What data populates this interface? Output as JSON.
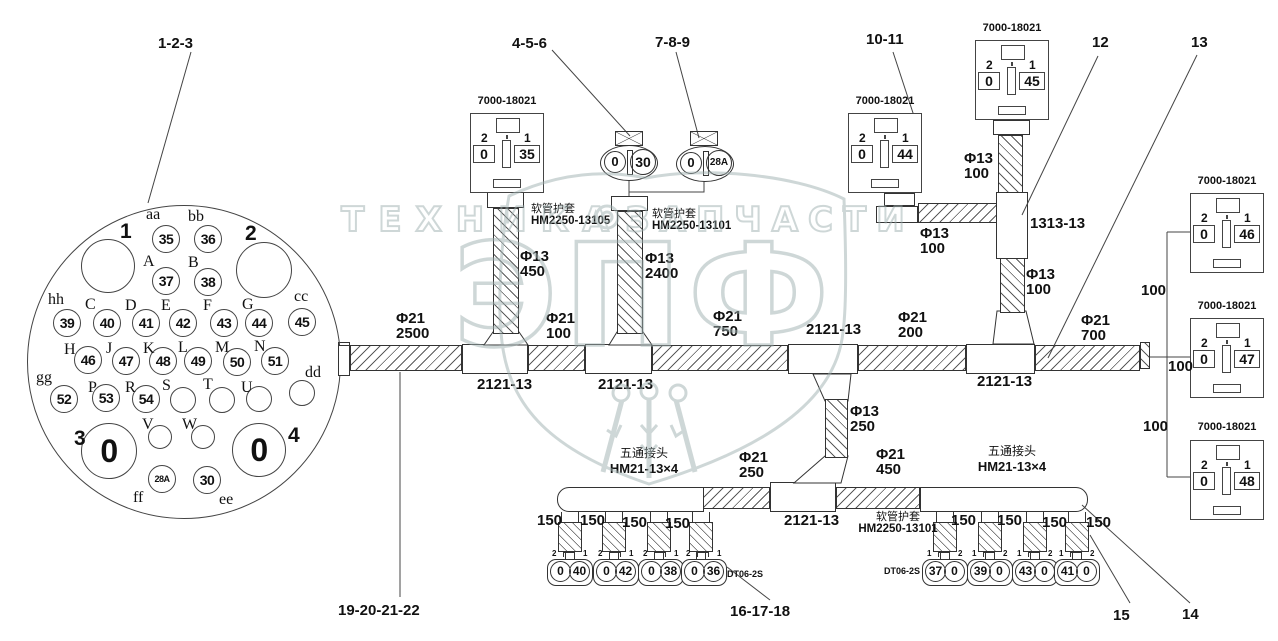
{
  "callouts": {
    "g1": "1-2-3",
    "g2": "4-5-6",
    "g3": "7-8-9",
    "g4": "10-11",
    "g5": "12",
    "g6": "13",
    "g7": "14",
    "g8": "15",
    "g9": "16-17-18",
    "g10": "19-20-21-22"
  },
  "part_numbers": {
    "square_connector": "7000-18021",
    "small_connector": "DT06-2S",
    "tee": "2121-13",
    "y_joint": "1313-13",
    "five_way_cn": "五通接头",
    "five_way": "HM21-13×4",
    "sleeve_cn": "软管护套",
    "sleeve_13105": "HM2250-13105",
    "sleeve_13101": "HM2250-13101"
  },
  "tubes": {
    "t2500": {
      "d": "Φ21",
      "l": "2500"
    },
    "t100a": {
      "d": "Φ21",
      "l": "100"
    },
    "t750": {
      "d": "Φ21",
      "l": "750"
    },
    "t200": {
      "d": "Φ21",
      "l": "200"
    },
    "t700": {
      "d": "Φ21",
      "l": "700"
    },
    "t450": {
      "d": "Φ13",
      "l": "450"
    },
    "t2400": {
      "d": "Φ13",
      "l": "2400"
    },
    "t100b": {
      "d": "Φ13",
      "l": "100"
    },
    "t100c": {
      "d": "Φ13",
      "l": "100"
    },
    "t100d": {
      "d": "Φ13",
      "l": "100"
    },
    "t250": {
      "d": "Φ13",
      "l": "250"
    },
    "t250b": {
      "d": "Φ21",
      "l": "250"
    },
    "t450b": {
      "d": "Φ21",
      "l": "450"
    }
  },
  "lengths": {
    "l150": "150",
    "l100": "100"
  },
  "sq_boxes": {
    "b35": {
      "pl": "2",
      "vl": "0",
      "pr": "1",
      "vr": "35"
    },
    "b44": {
      "pl": "2",
      "vl": "0",
      "pr": "1",
      "vr": "44"
    },
    "b45": {
      "pl": "2",
      "vl": "0",
      "pr": "1",
      "vr": "45"
    },
    "b46": {
      "pl": "2",
      "vl": "0",
      "pr": "1",
      "vr": "46"
    },
    "b47": {
      "pl": "2",
      "vl": "0",
      "pr": "1",
      "vr": "47"
    },
    "b48": {
      "pl": "2",
      "vl": "0",
      "pr": "1",
      "vr": "48"
    }
  },
  "ovals": {
    "o30": {
      "l": "0",
      "r": "30"
    },
    "o28a": {
      "l": "0",
      "r": "28A"
    }
  },
  "bconns": {
    "c40": {
      "pl": "2",
      "pr": "1",
      "l": "0",
      "r": "40"
    },
    "c42": {
      "pl": "2",
      "pr": "1",
      "l": "0",
      "r": "42"
    },
    "c38": {
      "pl": "2",
      "pr": "1",
      "l": "0",
      "r": "38"
    },
    "c36": {
      "pl": "2",
      "pr": "1",
      "l": "0",
      "r": "36"
    },
    "c37": {
      "pl": "1",
      "pr": "2",
      "l": "37",
      "r": "0"
    },
    "c39": {
      "pl": "1",
      "pr": "2",
      "l": "39",
      "r": "0"
    },
    "c43": {
      "pl": "1",
      "pr": "2",
      "l": "43",
      "r": "0"
    },
    "c41": {
      "pl": "1",
      "pr": "2",
      "l": "41",
      "r": "0"
    }
  },
  "circle": {
    "big1": {
      "label": "1"
    },
    "big2": {
      "label": "2"
    },
    "big3": {
      "label": "3",
      "num": "0"
    },
    "big4": {
      "label": "4",
      "num": "0"
    },
    "p35": {
      "label": "aa",
      "num": "35"
    },
    "p36": {
      "label": "bb",
      "num": "36"
    },
    "p37": {
      "label": "A",
      "num": "37"
    },
    "p38": {
      "label": "B",
      "num": "38"
    },
    "p39": {
      "label": "hh",
      "num": "39"
    },
    "p40": {
      "label": "C",
      "num": "40"
    },
    "p41": {
      "label": "D",
      "num": "41"
    },
    "p42": {
      "label": "E",
      "num": "42"
    },
    "p43": {
      "label": "F",
      "num": "43"
    },
    "p44": {
      "label": "G",
      "num": "44"
    },
    "p45": {
      "label": "cc",
      "num": "45"
    },
    "p46": {
      "label": "H",
      "num": "46"
    },
    "p47": {
      "label": "J",
      "num": "47"
    },
    "p48": {
      "label": "K",
      "num": "48"
    },
    "p49": {
      "label": "L",
      "num": "49"
    },
    "p50": {
      "label": "M",
      "num": "50"
    },
    "p51": {
      "label": "N",
      "num": "51"
    },
    "pdd": {
      "label": "dd"
    },
    "p52": {
      "label": "gg",
      "num": "52"
    },
    "p53": {
      "label": "P",
      "num": "53"
    },
    "p54": {
      "label": "R",
      "num": "54"
    },
    "pS": {
      "label": "S"
    },
    "pT": {
      "label": "T"
    },
    "pU": {
      "label": "U"
    },
    "pV": {
      "label": "V"
    },
    "pW": {
      "label": "W"
    },
    "p28A": {
      "label": "ff",
      "num": "28A"
    },
    "p30": {
      "label": "ee",
      "num": "30"
    }
  },
  "watermark": {
    "big": "ЭПФ",
    "left": "ТЕХНИКА",
    "right": "ЗАПЧАСТИ"
  }
}
